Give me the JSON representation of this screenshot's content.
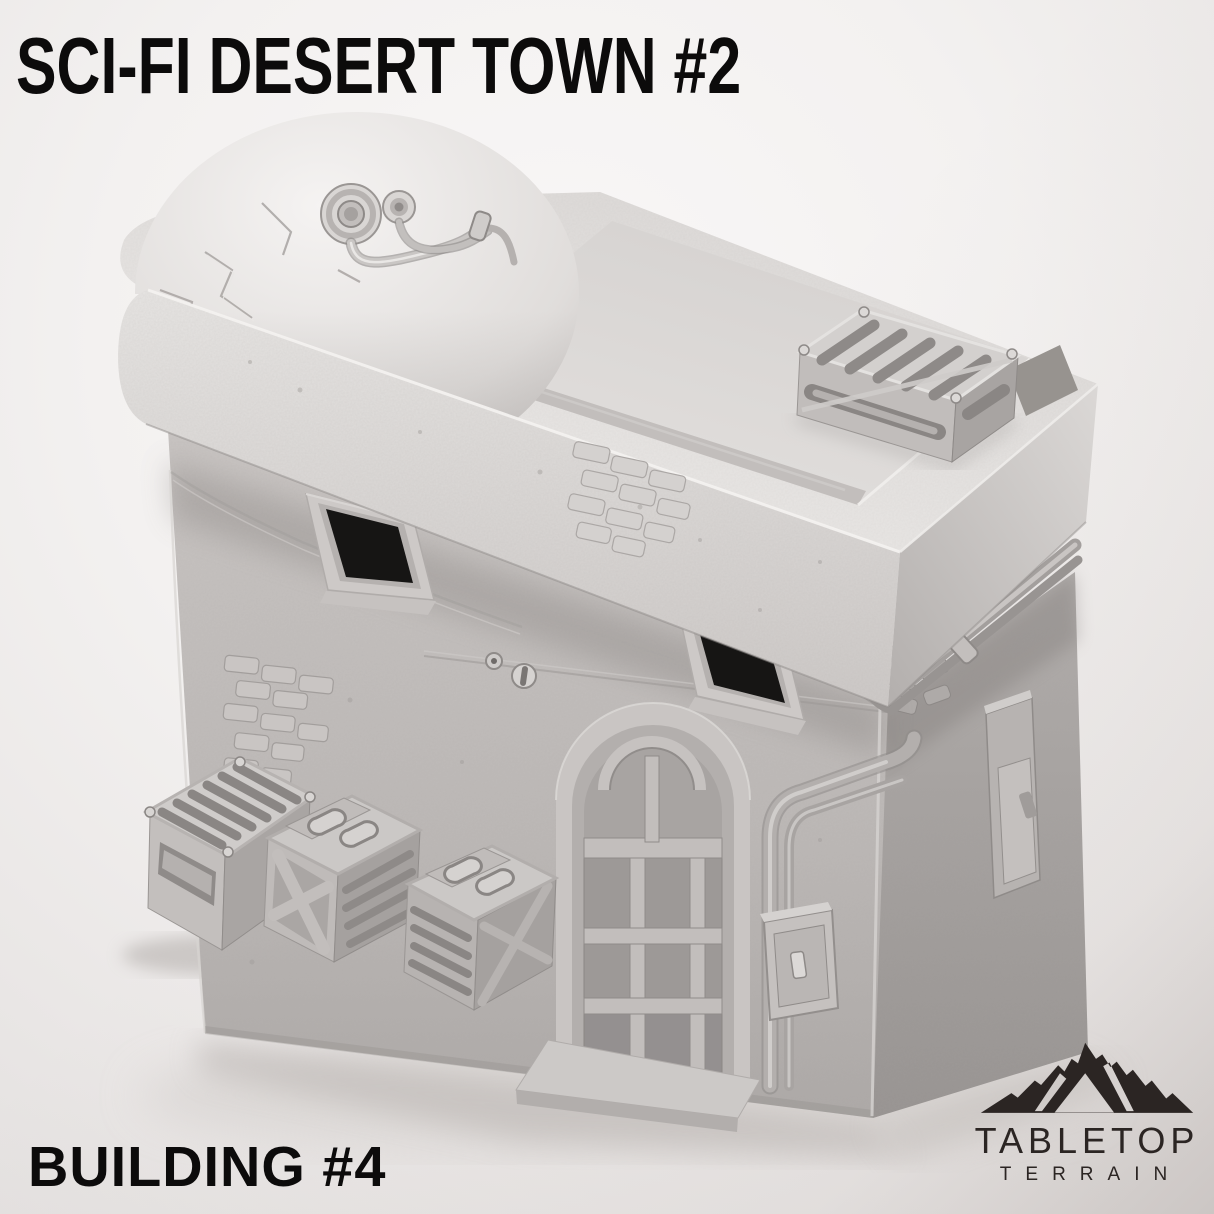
{
  "page": {
    "title": "SCI-FI DESERT TOWN #2",
    "footer_label": "BUILDING #4",
    "text_color": "#0c0b0b",
    "background_center": "#f7f5f5",
    "background_edge": "#e9e6e5",
    "corner_shade": "#d8d4d2"
  },
  "brand": {
    "name": "TABLETOP",
    "tagline": "TERRAIN",
    "color": "#2b2523",
    "icon": "mountain-icon"
  },
  "model": {
    "primary_color": "#c9c5c3",
    "shadow_color": "#a9a5a2",
    "highlight_color": "#efedec",
    "window_color": "#161514",
    "description": "Grey 3D render of a sci-fi desert town building: cracked observation dome with two cable ports, recessed flat roof with slatted vent, two splayed window openings, arched multi-pane door, exterior pipes with junction box, and three cargo crates"
  }
}
